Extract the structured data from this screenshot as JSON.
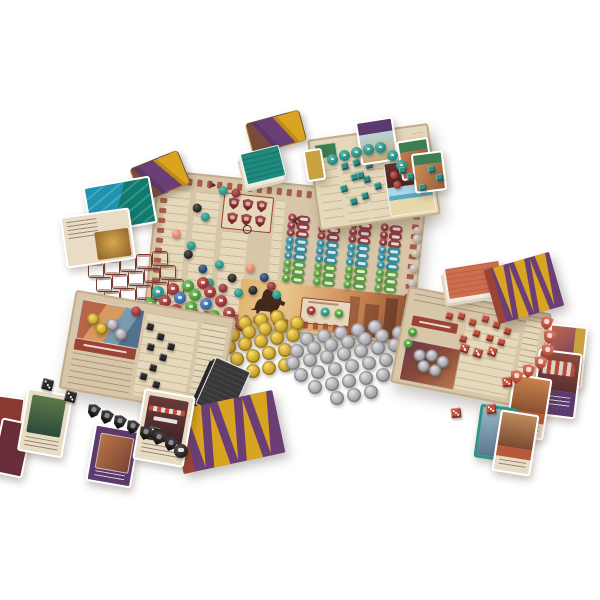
{
  "palette": {
    "parch": "#d7c6a7",
    "parch_light": "#e6d8ba",
    "parch_dark": "#c2ac8a",
    "brick": "#9c4434",
    "crimson": "#8e3a3e",
    "teal": "#35899b",
    "tealtoken": "#2f8f85",
    "green": "#5b9a3f",
    "goods_red": "#9c3a3a",
    "goods_green": "#4f9a3c",
    "goods_blue": "#3a6fae",
    "goods_teal": "#2f9488",
    "salmon": "#e2886e",
    "navy": "#2c4a70",
    "black": "#2d2a2c",
    "gold": "#c9a42e",
    "silver": "#a8a8ac",
    "purple": "#6b3f76",
    "yellow": "#d9a41f",
    "tent_brown": "#7a4a3a",
    "orange_deck": "#cf6e4e",
    "dark_card": "#3a373a",
    "red_piece": "#c14f3a",
    "red_shield": "#c75f4e",
    "teal_card_a": "#1f93b0",
    "teal_card_b": "#0f7a6e",
    "teal_deck": "#1f8a7e",
    "card_purple": "#5c3a6e",
    "card_green": "#3f7d52",
    "card_gold": "#c9a23f",
    "card_tan": "#e8dcc4"
  },
  "pieces": {
    "scrolls": {
      "size": [
        14,
        13
      ],
      "step": [
        16,
        -3
      ],
      "rows": [
        {
          "at": [
            88,
            263
          ],
          "n": 5
        },
        {
          "at": [
            96,
            277
          ],
          "n": 5
        },
        {
          "at": [
            104,
            291
          ],
          "n": 5
        },
        {
          "at": [
            118,
            305
          ],
          "n": 3
        }
      ]
    },
    "goods": {
      "size": 12,
      "step": [
        15,
        -3
      ],
      "rows": [
        {
          "at": [
            152,
            286
          ],
          "colors": [
            "goods_teal",
            "goods_red",
            "goods_green",
            "goods_red"
          ]
        },
        {
          "at": [
            144,
            298
          ],
          "colors": [
            "goods_green",
            "goods_red",
            "goods_blue",
            "goods_green",
            "goods_red"
          ]
        },
        {
          "at": [
            140,
            310
          ],
          "colors": [
            "goods_teal",
            "goods_green",
            "goods_red",
            "goods_green",
            "goods_blue",
            "goods_red"
          ]
        },
        {
          "at": [
            148,
            322
          ],
          "colors": [
            "goods_green",
            "goods_red",
            "goods_teal",
            "goods_blue",
            "goods_green",
            "goods_red"
          ]
        },
        {
          "at": [
            160,
            334
          ],
          "colors": [
            "goods_blue",
            "goods_green",
            "goods_red",
            "goods_green",
            "goods_teal",
            "goods_red"
          ]
        }
      ]
    },
    "gold_coins": {
      "size": 14,
      "step": [
        16,
        -3
      ],
      "rows": [
        {
          "at": [
            238,
            316
          ],
          "n": 3
        },
        {
          "at": [
            226,
            328
          ],
          "n": 5
        },
        {
          "at": [
            222,
            340
          ],
          "n": 5
        },
        {
          "at": [
            230,
            352
          ],
          "n": 4
        },
        {
          "at": [
            246,
            364
          ],
          "n": 3
        }
      ]
    },
    "silver_coins": {
      "size": 14,
      "step": [
        17,
        -3
      ],
      "rows": [
        {
          "at": [
            300,
            332
          ],
          "n": 5
        },
        {
          "at": [
            290,
            344
          ],
          "n": 7
        },
        {
          "at": [
            286,
            356
          ],
          "n": 8
        },
        {
          "at": [
            294,
            368
          ],
          "n": 8
        },
        {
          "at": [
            308,
            380
          ],
          "n": 6
        },
        {
          "at": [
            330,
            391
          ],
          "n": 3
        }
      ]
    },
    "main_board": {
      "scatter": [
        [
          60,
          8,
          "goods_teal"
        ],
        [
          73,
          9,
          "crimson"
        ],
        [
          36,
          28,
          "black"
        ],
        [
          45,
          36,
          "goods_teal"
        ],
        [
          18,
          56,
          "salmon"
        ],
        [
          34,
          66,
          "goods_teal"
        ],
        [
          32,
          75,
          "black"
        ],
        [
          48,
          88,
          "navy"
        ],
        [
          64,
          82,
          "goods_teal"
        ],
        [
          78,
          94,
          "black"
        ],
        [
          95,
          82,
          "salmon"
        ],
        [
          110,
          90,
          "navy"
        ],
        [
          56,
          101,
          "goods_teal"
        ],
        [
          70,
          105,
          "crimson"
        ],
        [
          86,
          108,
          "goods_teal"
        ],
        [
          100,
          104,
          "black"
        ],
        [
          118,
          98,
          "crimson"
        ],
        [
          124,
          106,
          "goods_teal"
        ]
      ],
      "grid": {
        "at": [
          132,
          28
        ],
        "row_step": 7.6,
        "col_step": 31,
        "cols": 4,
        "rows": [
          {
            "color": "crimson",
            "blank": true
          },
          {
            "color": "crimson",
            "blank": true
          },
          {
            "color": "crimson",
            "blank": false
          },
          {
            "color": "teal",
            "blank": true
          },
          {
            "color": "teal",
            "blank": false
          },
          {
            "color": "teal",
            "blank": true
          },
          {
            "color": "green",
            "blank": false
          },
          {
            "color": "green",
            "blank": true
          },
          {
            "color": "green",
            "blank": false
          }
        ]
      },
      "shield_rows": [
        3,
        3
      ],
      "reward_tokens": [
        "goods_red",
        "goods_teal",
        "goods_green"
      ]
    },
    "teal_tokens": [
      [
        327,
        154
      ],
      [
        339,
        150
      ],
      [
        351,
        147
      ],
      [
        363,
        144
      ],
      [
        375,
        142
      ],
      [
        387,
        150
      ],
      [
        396,
        160
      ]
    ],
    "teal_cubes": [
      [
        399,
        167
      ],
      [
        407,
        173
      ],
      [
        428,
        166
      ],
      [
        436,
        174
      ],
      [
        419,
        184
      ],
      [
        357,
        172
      ]
    ],
    "black_dice": [
      [
        42,
        379
      ],
      [
        65,
        391
      ],
      [
        149,
        427
      ]
    ],
    "red_dice": [
      [
        502,
        377
      ],
      [
        486,
        404
      ],
      [
        451,
        408
      ]
    ],
    "black_shields": [
      [
        87,
        404
      ],
      [
        100,
        410
      ],
      [
        113,
        415
      ],
      [
        126,
        420
      ],
      [
        139,
        426
      ],
      [
        152,
        431
      ],
      [
        164,
        437
      ]
    ],
    "black_medallion": [
      174,
      444
    ],
    "red_shields": [
      [
        540,
        316
      ],
      [
        543,
        330
      ],
      [
        541,
        344
      ],
      [
        534,
        356
      ],
      [
        522,
        364
      ],
      [
        510,
        370
      ]
    ],
    "red_board": {
      "cubes": [
        [
          40,
          16
        ],
        [
          52,
          14
        ],
        [
          64,
          18
        ],
        [
          76,
          12
        ],
        [
          88,
          16
        ],
        [
          100,
          20
        ],
        [
          70,
          28
        ],
        [
          84,
          30
        ],
        [
          96,
          32
        ],
        [
          58,
          36
        ]
      ],
      "dice": [
        [
          60,
          44
        ],
        [
          74,
          46
        ],
        [
          88,
          42
        ]
      ],
      "greens": [
        [
          6,
          38
        ],
        [
          4,
          50
        ]
      ],
      "coins": [
        [
          16,
          58
        ],
        [
          28,
          56
        ],
        [
          40,
          60
        ],
        [
          22,
          68
        ],
        [
          34,
          70
        ]
      ]
    },
    "teal_board": {
      "cubes": [
        [
          28,
          26
        ],
        [
          40,
          24
        ],
        [
          52,
          28
        ],
        [
          36,
          38
        ],
        [
          48,
          42
        ],
        [
          24,
          48
        ],
        [
          58,
          50
        ],
        [
          44,
          58
        ],
        [
          32,
          62
        ]
      ],
      "art_tokens": [
        [
          4,
          8,
          "goods_red"
        ],
        [
          14,
          6,
          "goods_teal"
        ],
        [
          24,
          8,
          "goods_teal"
        ],
        [
          6,
          18,
          "goods_red"
        ]
      ]
    },
    "black_board": {
      "cubes": [
        [
          74,
          18
        ],
        [
          86,
          26
        ],
        [
          78,
          38
        ],
        [
          92,
          46
        ],
        [
          84,
          58
        ],
        [
          76,
          68
        ],
        [
          90,
          74
        ],
        [
          98,
          34
        ]
      ],
      "gold": [
        [
          14,
          18
        ],
        [
          24,
          26
        ]
      ],
      "silver": [
        [
          34,
          20
        ],
        [
          44,
          28
        ]
      ],
      "marker": [
        56,
        4
      ]
    }
  }
}
